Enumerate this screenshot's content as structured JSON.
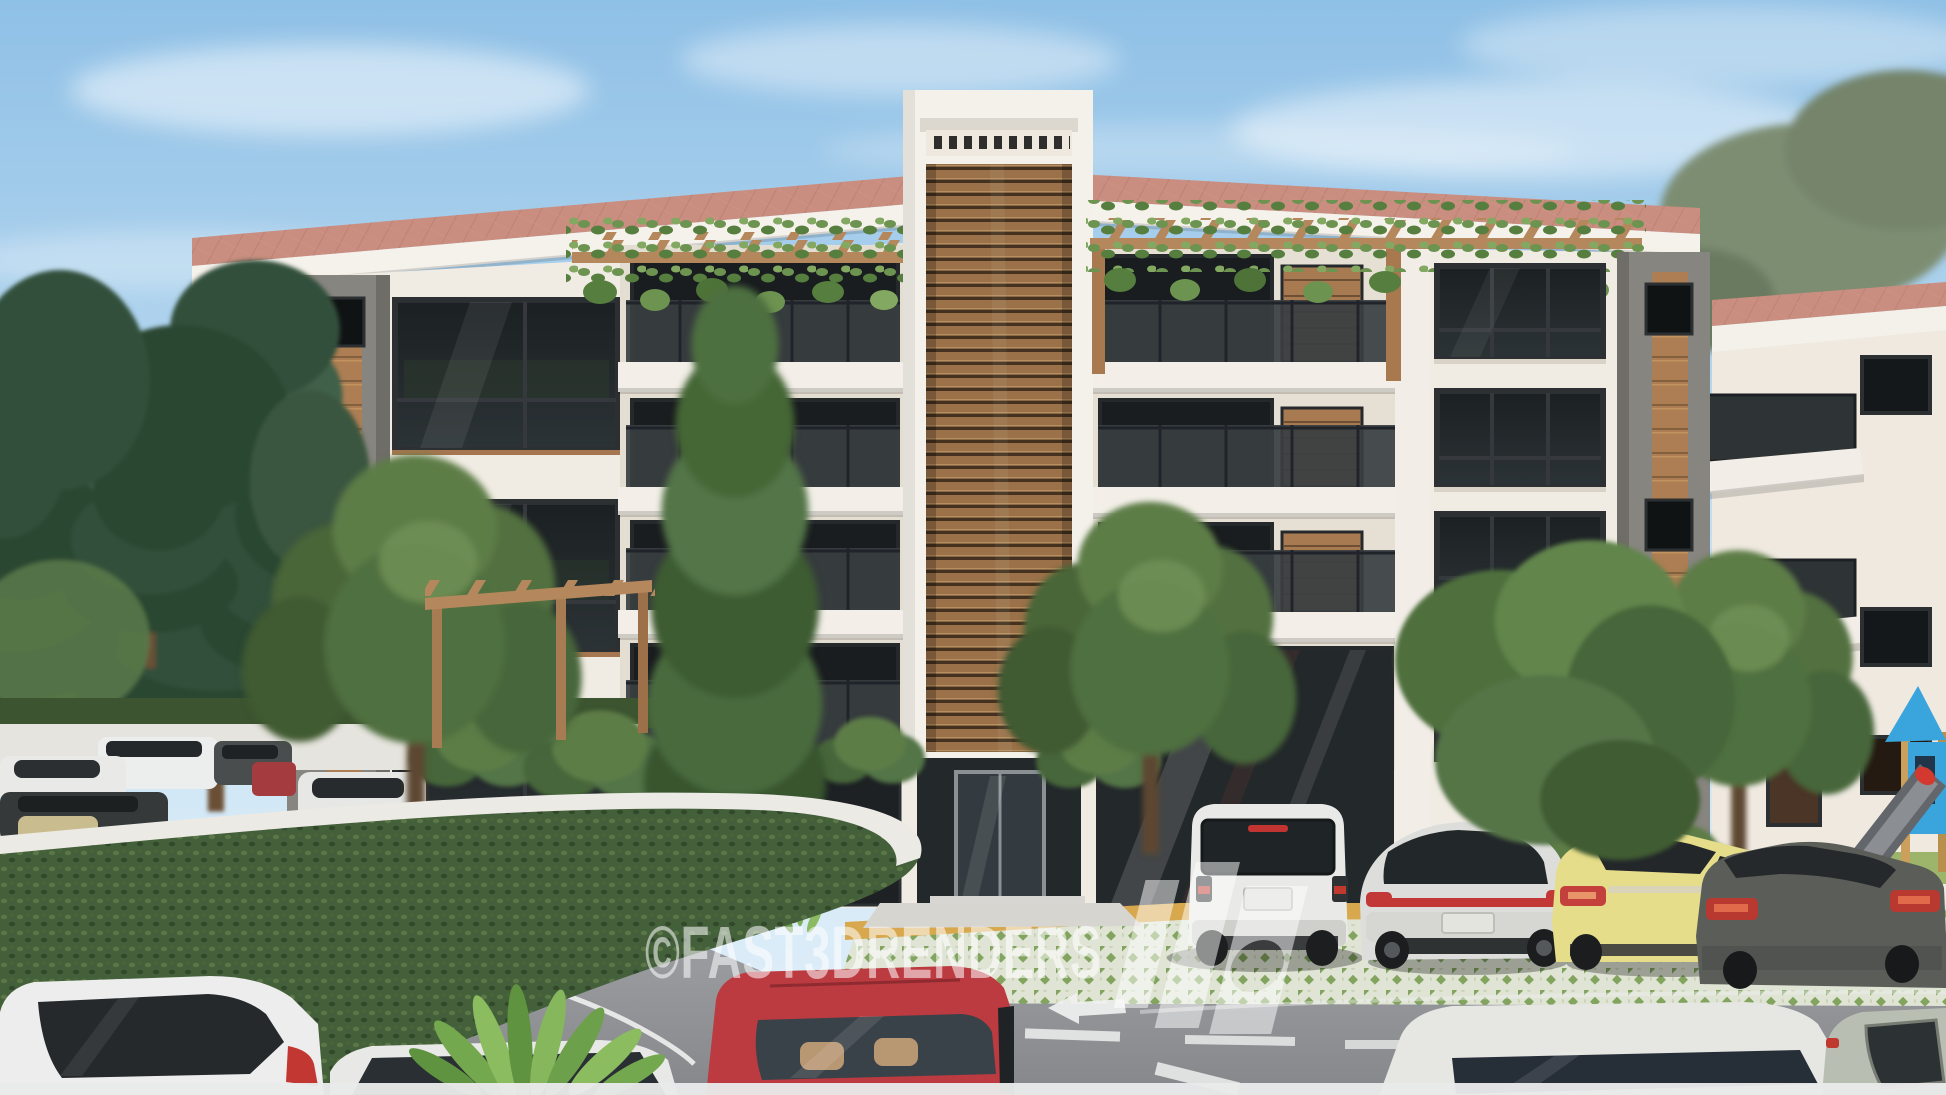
{
  "meta": {
    "title": "Apartment building exterior - 3D architectural render",
    "width": 1946,
    "height": 1095
  },
  "watermark": {
    "copyright_text": "©FAST3DRENDERS",
    "logo_name": "fast3d-slab-logo",
    "color": "#ffffff",
    "opacity": 0.55
  },
  "palette": {
    "sky_top": "#8fc0e6",
    "sky_horizon": "#e2f0f9",
    "roof_tile": "#ca8e80",
    "fascia": "#f5f2ec",
    "wall": "#f1ece3",
    "wall_recess": "#e4ddd2",
    "stone": "#87857f",
    "wood_accent": "#ad7e53",
    "louver_wood": "#9a7148",
    "glass_dark": "#16191b",
    "window_frame": "#2c3033",
    "railing_glass": "#383e41",
    "parapet": "#f3efe8",
    "pergola_wood": "#b5875c",
    "vine_green": "#6d9350",
    "pine_green": "#33503a",
    "tree_green": "#53713f",
    "hedge_green": "#44603a",
    "coping": "#eceae4",
    "hill_green": "#acba6f",
    "asphalt": "#97999d",
    "paver": "#dfe4d4",
    "paver_green": "#82a45f",
    "curb_yellow": "#d8a84f",
    "marking_white": "#f0f1f0",
    "entrance_stone": "#23282b",
    "car_white": "#e9eae8",
    "car_red": "#bb3b40",
    "car_yellow": "#e6dd8a",
    "car_dark_gray": "#5b5d59",
    "car_sage": "#b9beb3",
    "playground_blue": "#3aa4dc",
    "slide_gray": "#63666a",
    "grass_green": "#9db56a"
  }
}
